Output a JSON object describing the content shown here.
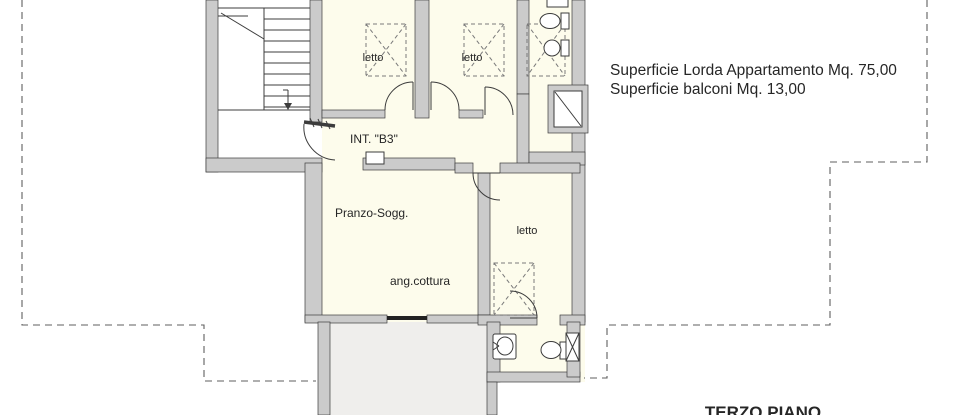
{
  "plan": {
    "rooms": {
      "bedroom1": "letto",
      "bedroom2": "letto",
      "bedroom3": "letto",
      "living": "Pranzo-Sogg.",
      "kitchen": "ang.cottura",
      "unit": "INT. \"B3\""
    },
    "annotations": {
      "gross_area": "Superficie Lorda Appartamento Mq. 75,00",
      "balcony_area": "Superficie balconi Mq. 13,00",
      "floor_label": "TERZO PIANO"
    },
    "colors": {
      "wall": "#cbcbcb",
      "line": "#3c3c3c",
      "room": "#fdfcec",
      "balcony": "#efeeec",
      "dashed": "#5f5f5f",
      "text": "#262626"
    }
  }
}
